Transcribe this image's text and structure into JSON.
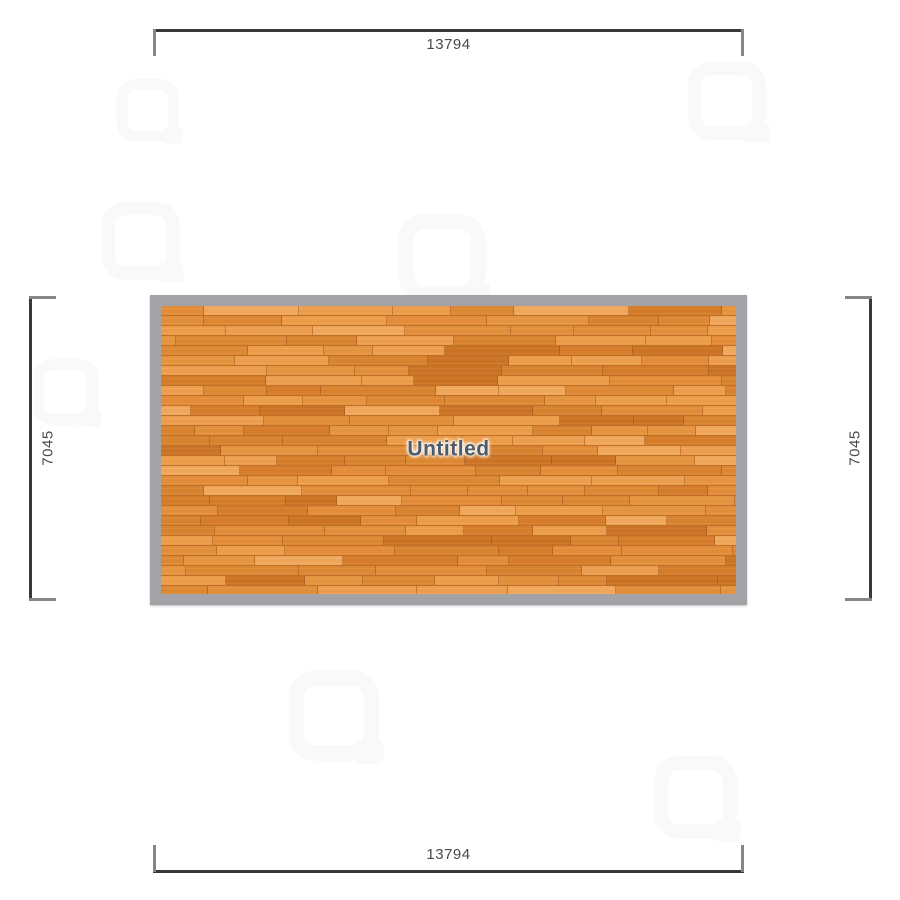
{
  "floorplan": {
    "room": {
      "label": "Untitled"
    },
    "dimensions": {
      "top": "13794",
      "bottom": "13794",
      "left": "7045",
      "right": "7045"
    },
    "icons": {
      "watermark": "floorplanner-watermark-icon"
    },
    "colors": {
      "wall": "#a3a3a7",
      "floor_base": "#e08a38",
      "plank_palette": [
        "#ef9f4a",
        "#e8963f",
        "#e08a34",
        "#d87e2b",
        "#cf7526",
        "#f0a050",
        "#db8530",
        "#f3a95c",
        "#e4913b",
        "#e68f3a"
      ],
      "dimension_line": "#38383c",
      "dimension_tick": "#85858a",
      "dimension_text": "#4a4a4e",
      "room_label_text": "#4e5b68"
    }
  }
}
